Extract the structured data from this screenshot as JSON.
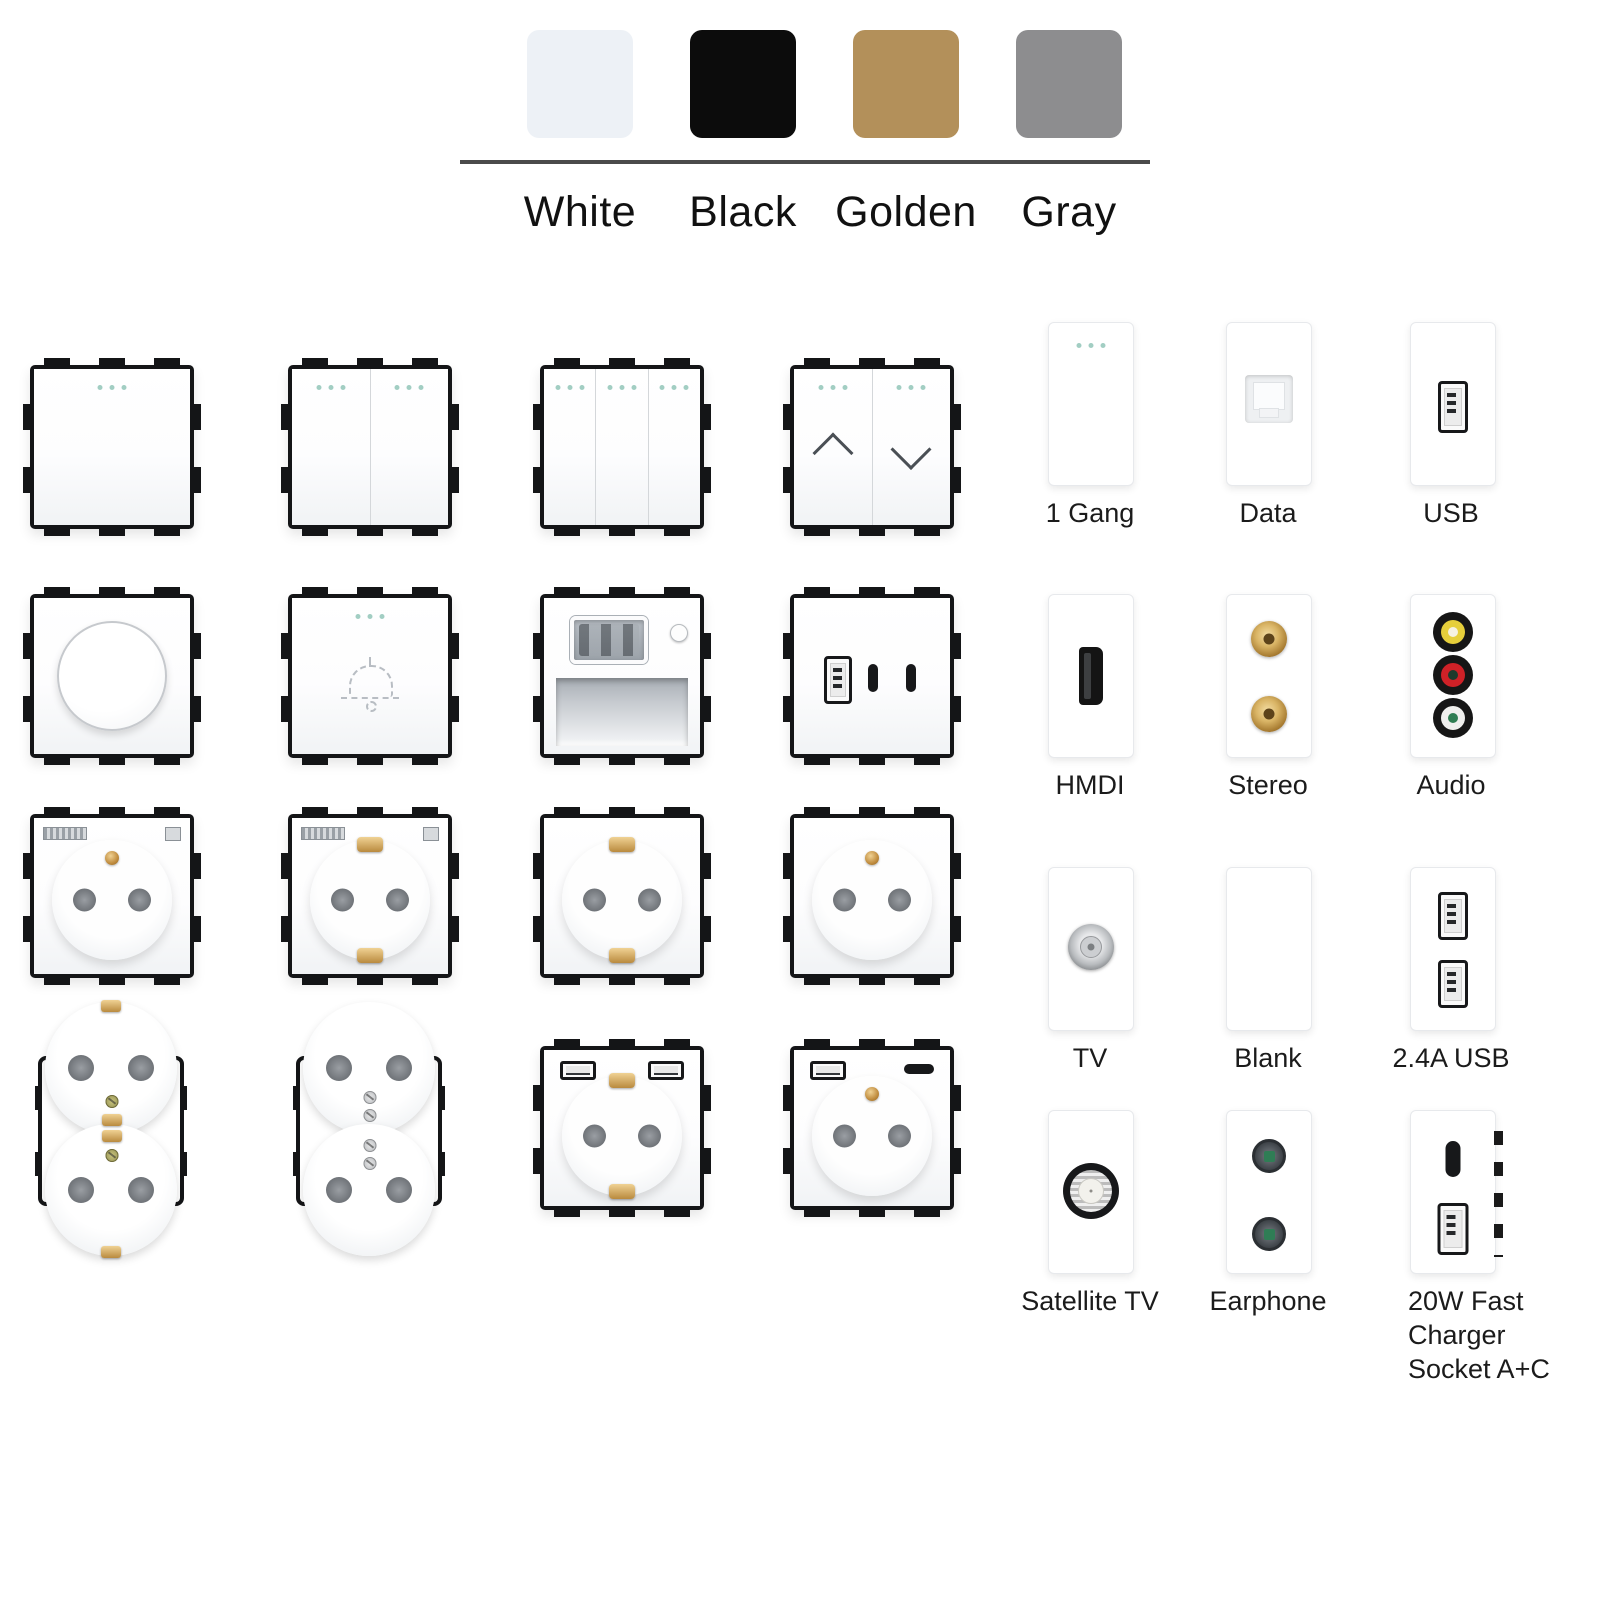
{
  "header": {
    "swatches": [
      {
        "label": "White",
        "color": "#edf1f6"
      },
      {
        "label": "Black",
        "color": "#0c0c0c"
      },
      {
        "label": "Golden",
        "color": "#b3905a"
      },
      {
        "label": "Gray",
        "color": "#8d8d8f"
      }
    ]
  },
  "module_labels": [
    {
      "label": "1 Gang"
    },
    {
      "label": "Data"
    },
    {
      "label": "USB"
    },
    {
      "label": "HMDI"
    },
    {
      "label": "Stereo"
    },
    {
      "label": "Audio"
    },
    {
      "label": "TV"
    },
    {
      "label": "Blank"
    },
    {
      "label": "2.4A USB"
    },
    {
      "label": "Satellite TV"
    },
    {
      "label": "Earphone"
    },
    {
      "label": "20W Fast Charger",
      "label2": "Socket A+C"
    }
  ],
  "accents": {
    "indicator_dot": "#a2cec3",
    "panel_frame": "#141517",
    "brass": "#c08c3e",
    "divider_line": "#4b4b4b",
    "audio_yellow": "#e6cf3b",
    "audio_red": "#cf2127",
    "audio_white": "#efefed",
    "jack_green": "#2f7d52"
  },
  "icons": {
    "indicator-dots": "three-dot-led",
    "up-arrow": "chevron-up",
    "down-arrow": "chevron-down",
    "doorbell": "dashed-bell-outline",
    "usb-a": "usb-a-port",
    "usb-c": "usb-c-pill",
    "hdmi": "hdmi-port",
    "rj45": "data-keystone",
    "rca": "gold-rca-jack",
    "coax": "tv-coax-connector",
    "f-connector": "satellite-f-connector",
    "audio-jack": "3.5mm-jack"
  }
}
